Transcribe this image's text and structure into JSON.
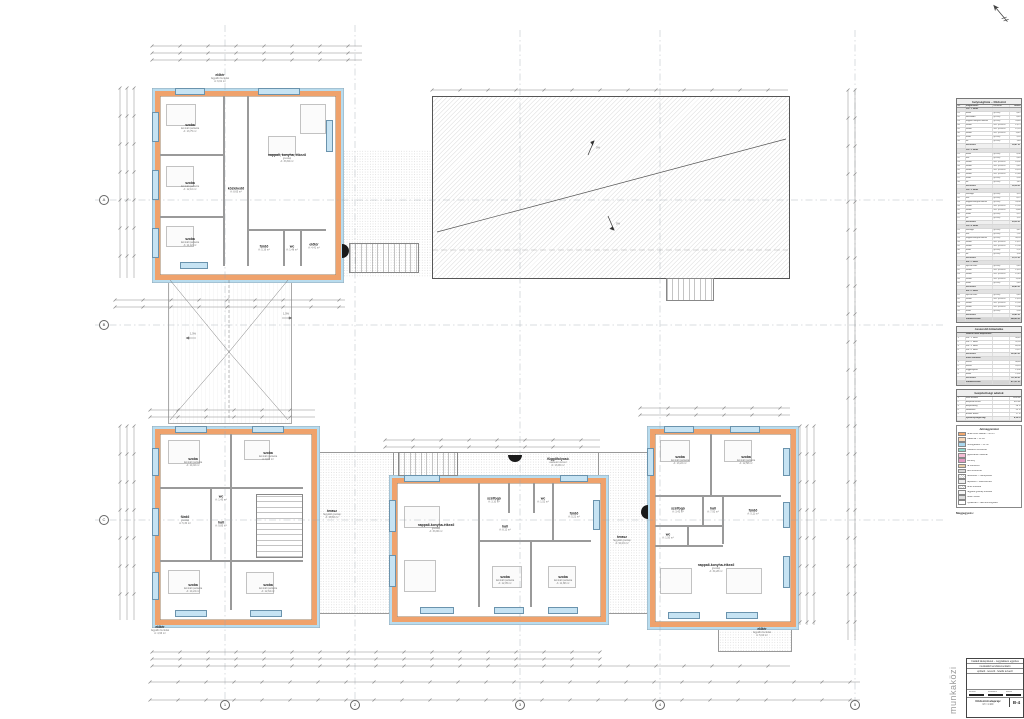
{
  "sheet": {
    "watermark": "munkaközi",
    "north_label": "É",
    "grid_cols": [
      "1",
      "2",
      "3",
      "4",
      "5"
    ],
    "grid_rows": [
      "A",
      "B",
      "C"
    ]
  },
  "buildings": {
    "nw": {
      "rooms": [
        {
          "n": "szoba",
          "a1": "laminált parketta",
          "a2": "A: 13,75 m²"
        },
        {
          "n": "nappali, konyha, étkező",
          "a1": "greslap",
          "a2": "A: 33,84 m²"
        },
        {
          "n": "szoba",
          "a1": "laminált parketta",
          "a2": "A: 12,10 m²"
        },
        {
          "n": "közlekedő",
          "a1": "greslap",
          "a2": "A: 8,65 m²"
        },
        {
          "n": "szoba",
          "a1": "laminált parketta",
          "a2": "A: 11,42 m²"
        },
        {
          "n": "fürdő",
          "a1": "greslap",
          "a2": "A: 5,16 m²"
        },
        {
          "n": "wc",
          "a1": "greslap",
          "a2": "A: 1,48 m²"
        },
        {
          "n": "előtér",
          "a1": "greslap",
          "a2": "A: 4,41 m²"
        }
      ],
      "top_label": {
        "n": "előtér",
        "a1": "fagyálló burkolat",
        "a2": "A: 6,61 m²"
      }
    },
    "sw": {
      "rooms": [
        {
          "n": "szoba",
          "a1": "laminált parketta",
          "a2": "A: 14,02 m²"
        },
        {
          "n": "szoba",
          "a1": "laminált parketta",
          "a2": "A: 9,81 m²"
        },
        {
          "n": "fürdő",
          "a1": "greslap",
          "a2": "A: 5,30 m²"
        },
        {
          "n": "hall",
          "a1": "greslap",
          "a2": "A: 9,85 m²"
        },
        {
          "n": "wc",
          "a1": "greslap",
          "a2": "A: 1,45 m²"
        },
        {
          "n": "szoba",
          "a1": "laminált parketta",
          "a2": "A: 14,24 m²"
        },
        {
          "n": "szoba",
          "a1": "laminált parketta",
          "a2": "A: 12,64 m²"
        }
      ],
      "bottom_label": {
        "n": "előtér",
        "a1": "fagyálló burkolat",
        "a2": "A: 4,96 m²"
      }
    },
    "sc": {
      "rooms": [
        {
          "n": "nappali-konyha-étkező",
          "a1": "greslap",
          "a2": "A: 33,96 m²"
        },
        {
          "n": "szélfogó",
          "a1": "greslap",
          "a2": "A: 3,10 m²"
        },
        {
          "n": "wc",
          "a1": "greslap",
          "a2": "A: 1,52 m²"
        },
        {
          "n": "fürdő",
          "a1": "greslap",
          "a2": "A: 5,21 m²"
        },
        {
          "n": "hall",
          "a1": "greslap",
          "a2": "A: 8,12 m²"
        },
        {
          "n": "szoba",
          "a1": "laminált parketta",
          "a2": "A: 12,05 m²"
        },
        {
          "n": "szoba",
          "a1": "laminált parketta",
          "a2": "A: 11,88 m²"
        }
      ],
      "top_label": {
        "n": "függőfolyosó",
        "a1": "vasbeton lemez",
        "a2": "A: 13,96 m²"
      }
    },
    "se": {
      "rooms": [
        {
          "n": "szoba",
          "a1": "laminált parketta",
          "a2": "A: 13,22 m²"
        },
        {
          "n": "szoba",
          "a1": "laminált parketta",
          "a2": "A: 12,58 m²"
        },
        {
          "n": "hall",
          "a1": "greslap",
          "a2": "A: 7,92 m²"
        },
        {
          "n": "szélfogó",
          "a1": "greslap",
          "a2": "A: 3,42 m²"
        },
        {
          "n": "fürdő",
          "a1": "greslap",
          "a2": "A: 5,11 m²"
        },
        {
          "n": "wc",
          "a1": "greslap",
          "a2": "A: 1,50 m²"
        },
        {
          "n": "nappali-konyha-étkező",
          "a1": "greslap",
          "a2": "A: 34,28 m²"
        }
      ],
      "bottom_label": {
        "n": "előtér",
        "a1": "fagyálló burkolat",
        "a2": "A: 5,04 m²"
      }
    }
  },
  "site_labels": {
    "terasz_a": {
      "n": "terasz",
      "a1": "fagyálló greslap",
      "a2": "A: 48,60 m²"
    },
    "terasz_b": {
      "n": "terasz",
      "a1": "fagyálló greslap",
      "a2": "A: 24,10 m²"
    },
    "court_slope1": "1,5%",
    "court_slope2": "1,5%",
    "roof_slope1": "5%",
    "roof_slope2": "5%"
  },
  "sidebar": {
    "table1": {
      "title": "helyiséglista – földszint",
      "headers": [
        "sz.",
        "megnevezés",
        "burkolat",
        "terület"
      ],
      "rows": [
        [
          "g",
          "",
          "Fsz. 1. lakás",
          "",
          ""
        ],
        [
          "r",
          "01",
          "előtér",
          "greslap",
          "4,41"
        ],
        [
          "r",
          "02",
          "közlekedő",
          "greslap",
          "8,65"
        ],
        [
          "r",
          "03",
          "nappali+konyha+étkező",
          "greslap",
          "33,84"
        ],
        [
          "r",
          "04",
          "szoba",
          "lam. parketta",
          "13,75"
        ],
        [
          "r",
          "05",
          "szoba",
          "lam. parketta",
          "12,10"
        ],
        [
          "r",
          "06",
          "szoba",
          "lam. parketta",
          "11,42"
        ],
        [
          "r",
          "07",
          "fürdő",
          "greslap",
          "5,16"
        ],
        [
          "r",
          "08",
          "wc",
          "greslap",
          "1,48"
        ],
        [
          "s",
          "",
          "összesen:",
          "",
          "90,81 m²"
        ],
        [
          "g",
          "",
          "Fsz. 2. lakás",
          "",
          ""
        ],
        [
          "r",
          "01",
          "előtér",
          "greslap",
          "4,96"
        ],
        [
          "r",
          "02",
          "hall",
          "greslap",
          "9,85"
        ],
        [
          "r",
          "03",
          "szoba",
          "lam. parketta",
          "14,02"
        ],
        [
          "r",
          "04",
          "szoba",
          "lam. parketta",
          "9,81"
        ],
        [
          "r",
          "05",
          "szoba",
          "lam. parketta",
          "14,24"
        ],
        [
          "r",
          "06",
          "szoba",
          "lam. parketta",
          "12,64"
        ],
        [
          "r",
          "07",
          "fürdő",
          "greslap",
          "5,30"
        ],
        [
          "r",
          "08",
          "wc",
          "greslap",
          "1,45"
        ],
        [
          "s",
          "",
          "összesen:",
          "",
          "92,34 m²"
        ],
        [
          "g",
          "",
          "Fsz. 3. lakás",
          "",
          ""
        ],
        [
          "r",
          "01",
          "szélfogó",
          "greslap",
          "3,10"
        ],
        [
          "r",
          "02",
          "hall",
          "greslap",
          "8,12"
        ],
        [
          "r",
          "03",
          "nappali-konyha-étkező",
          "greslap",
          "33,96"
        ],
        [
          "r",
          "04",
          "szoba",
          "lam. parketta",
          "12,05"
        ],
        [
          "r",
          "05",
          "szoba",
          "lam. parketta",
          "11,88"
        ],
        [
          "r",
          "06",
          "fürdő",
          "greslap",
          "5,21"
        ],
        [
          "r",
          "07",
          "wc",
          "greslap",
          "1,52"
        ],
        [
          "s",
          "",
          "összesen:",
          "",
          "89,56 m²"
        ],
        [
          "g",
          "",
          "Fsz. 4. lakás",
          "",
          ""
        ],
        [
          "r",
          "01",
          "szélfogó",
          "greslap",
          "3,42"
        ],
        [
          "r",
          "02",
          "hall",
          "greslap",
          "7,92"
        ],
        [
          "r",
          "03",
          "nappali-konyha-étkező",
          "greslap",
          "34,28"
        ],
        [
          "r",
          "04",
          "szoba",
          "lam. parketta",
          "13,22"
        ],
        [
          "r",
          "05",
          "szoba",
          "lam. parketta",
          "12,58"
        ],
        [
          "r",
          "06",
          "fürdő",
          "greslap",
          "5,11"
        ],
        [
          "r",
          "07",
          "wc",
          "greslap",
          "1,50"
        ],
        [
          "s",
          "",
          "összesen:",
          "",
          "91,12 m²"
        ],
        [
          "g",
          "",
          "Em. 1. lakás",
          "",
          ""
        ],
        [
          "r",
          "01",
          "lépcső+közl.",
          "greslap",
          "9,40"
        ],
        [
          "r",
          "02",
          "szoba",
          "lam. parketta",
          "13,10"
        ],
        [
          "r",
          "03",
          "szoba",
          "lam. parketta",
          "12,45"
        ],
        [
          "r",
          "04",
          "szoba",
          "lam. parketta",
          "11,96"
        ],
        [
          "r",
          "05",
          "fürdő",
          "greslap",
          "5,40"
        ],
        [
          "s",
          "",
          "összesen:",
          "",
          "86,40 m²"
        ],
        [
          "g",
          "",
          "Em. 2. lakás",
          "",
          ""
        ],
        [
          "r",
          "01",
          "lépcső+közl.",
          "greslap",
          "9,40"
        ],
        [
          "r",
          "02",
          "szoba",
          "lam. parketta",
          "13,24"
        ],
        [
          "r",
          "03",
          "szoba",
          "lam. parketta",
          "12,30"
        ],
        [
          "r",
          "04",
          "szoba",
          "lam. parketta",
          "12,08"
        ],
        [
          "r",
          "05",
          "fürdő",
          "greslap",
          "5,38"
        ],
        [
          "s",
          "",
          "összesen:",
          "",
          "90,42 m²"
        ],
        [
          "t",
          "",
          "mindösszesen:",
          "",
          "540,65 m²"
        ]
      ]
    },
    "table2": {
      "title": "összesítő kimutatás",
      "rows": [
        [
          "g",
          "",
          "lakások nettó alapterülete",
          "",
          ""
        ],
        [
          "r",
          "1.",
          "Fsz. 1. lakás",
          "",
          "90,81"
        ],
        [
          "r",
          "2.",
          "Fsz. 2. lakás",
          "",
          "92,34"
        ],
        [
          "r",
          "3.",
          "Fsz. 3. lakás",
          "",
          "89,56"
        ],
        [
          "r",
          "4.",
          "Fsz. 4. lakás",
          "",
          "91,12"
        ],
        [
          "s",
          "",
          "összesen:",
          "",
          "363,83 m²"
        ],
        [
          "g",
          "",
          "külső területek",
          "",
          ""
        ],
        [
          "r",
          "1.",
          "terasz",
          "",
          "48,60"
        ],
        [
          "r",
          "2.",
          "terasz",
          "",
          "24,10"
        ],
        [
          "r",
          "3.",
          "függőfolyosó",
          "",
          "13,96"
        ],
        [
          "r",
          "4.",
          "előtér",
          "",
          "21,02"
        ],
        [
          "s",
          "",
          "összesen:",
          "",
          "107,68 m²"
        ],
        [
          "t",
          "",
          "mindösszesen:",
          "",
          "471,51 m²"
        ]
      ]
    },
    "table3": {
      "title": "beépítettségi adatok",
      "rows": [
        [
          "r",
          "1.",
          "telek területe",
          "",
          "1500 m²"
        ],
        [
          "r",
          "2.",
          "beépített terület",
          "",
          "420 m²"
        ],
        [
          "r",
          "3.",
          "beépítettség",
          "",
          "28 %"
        ],
        [
          "r",
          "4.",
          "zöldfelület",
          "",
          "55 %"
        ],
        [
          "r",
          "5.",
          "burkolt felület",
          "",
          "17 %"
        ],
        [
          "s",
          "",
          "építménymagasság:",
          "",
          "4,50 m"
        ]
      ]
    },
    "legend": {
      "title": "Jelmagyarázat",
      "items": [
        {
          "color": "#f2a86e",
          "hatch": false,
          "label": "teherhordó falazat – 30 cm"
        },
        {
          "color": "#f7d9bc",
          "hatch": false,
          "label": "válaszfal – 10 cm"
        },
        {
          "color": "#aad8ee",
          "hatch": false,
          "label": "hőszigetelés – 15 cm"
        },
        {
          "color": "#8fd8cc",
          "hatch": false,
          "label": "vasbeton szerkezet"
        },
        {
          "color": "#f4bcd4",
          "hatch": false,
          "label": "gipszkarton előtétfal"
        },
        {
          "color": "#e29ac2",
          "hatch": false,
          "label": "kémény"
        },
        {
          "color": "#e8cda6",
          "hatch": false,
          "label": "fa szerkezet"
        },
        {
          "color": "#d9d9d9",
          "hatch": false,
          "label": "acél szerkezet"
        },
        {
          "color": "#ffffff",
          "hatch": true,
          "label": "tetőfelület – cserépfedés"
        },
        {
          "color": "#efefef",
          "hatch": false,
          "label": "lapostető – kavicsterítés"
        },
        {
          "color": "#ffffff",
          "hatch": true,
          "label": "térkő burkolat"
        },
        {
          "color": "#f7f7f7",
          "hatch": false,
          "label": "fagyálló greslap burkolat"
        },
        {
          "color": "#dddddd",
          "hatch": false,
          "label": "beton felület"
        },
        {
          "color": "#ffffff",
          "hatch": false,
          "label": "nyílászáró – lásd konszignáció"
        }
      ]
    },
    "notes": {
      "title": "Megjegyzés:",
      "paragraphs": [
        "1. A terven szereplő méretek a helyszínen ellenőrizendők, eltérés esetén a tervezőt értesíteni kell.",
        "2. A terv a vonatkozó szabványok és hatósági előírások figyelembevételével készült.",
        "3. Minden méret cm-ben, a szintmagasságok m-ben értendők.",
        "4. A nyílászárók pontos mérete gyártás előtt helyszíni felméréssel pontosítandó.",
        "5. Az épületgépészeti és elektromos kialakítást lásd a szakági terveken.",
        "6. A tartószerkezeti elemeket lásd a tartószerkezeti tervdokumentációban.",
        "7. A hő- és vízszigetelések a rétegrendi kimutatás szerint készítendők.",
        "8. A terv szerzői jogvédelem alatt áll, a tervező hozzájárulása nélkül nem módosítható."
      ]
    },
    "titleblock": {
      "line1": "Családi lakóépületek – négylakásos együttes",
      "line2": "munkaközi tervdokumentáció",
      "line3": "építtető · tervező · felelős tervező",
      "body": "",
      "sig1": "tervező",
      "sig2": "munkatárs",
      "sig3": "ellenőr",
      "plan_title": "földszinti alaprajz",
      "plan_scale": "M = 1:100",
      "sheet_no": "B-4"
    }
  }
}
